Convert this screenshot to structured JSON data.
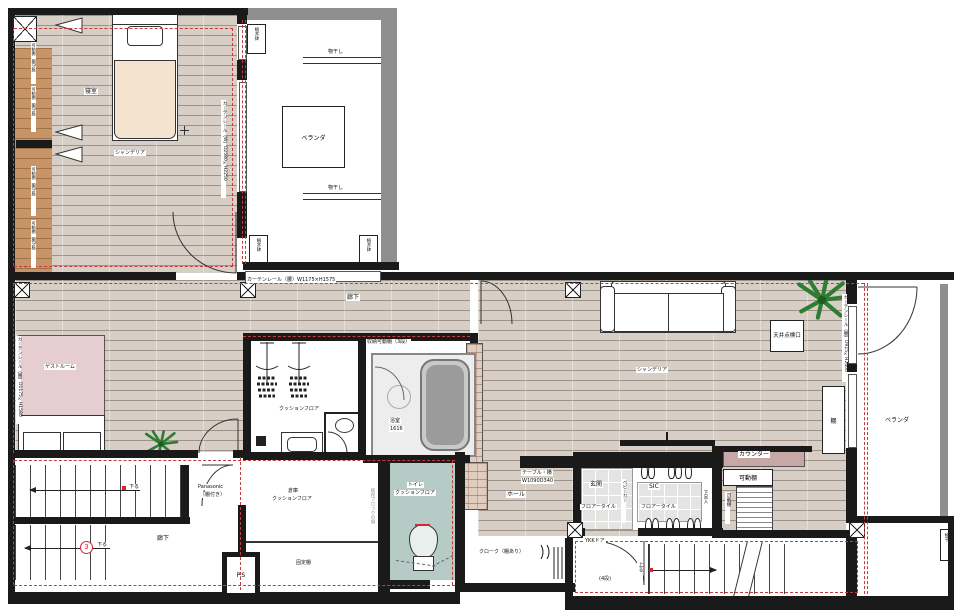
{
  "colors": {
    "wall": "#1a1a1a",
    "gray_wall": "#8f8f8f",
    "red_line": "#c43b3b",
    "wood_floor": "#d7cec6",
    "closet_wood": "#c79467",
    "guest_bed": "#e5cdd1",
    "toilet_floor": "#b6cac6",
    "counter": "#c8a7a7",
    "plant": "#2e7d32",
    "duvet": "#f4e4cf"
  },
  "labels": {
    "bedroom": "寝室",
    "bedroom_chandelier": "シャンデリア",
    "bedroom_curtain": "カーテンレール（W）D2580×H2250",
    "closet_shelf": "可動棚（棚5段）",
    "balcony_top": "ベランダ",
    "laundry_pole": "物干し",
    "planter": "植木鉢",
    "corridor_top": "廊下",
    "corridor_curtain": "カーテンレール（腰）W1175×H1575",
    "guest_room": "ゲストルーム",
    "guest_curtain": "カーテンレール（腰）D1175×H1580",
    "wic_floor": "クッションフロア",
    "wic_shelf": "収納可動棚（3段）",
    "bath": "浴室",
    "bath_size": "1616",
    "living_chandelier": "シャンデリア",
    "ceiling_hatch": "天井点検口",
    "shelf": "棚",
    "counter": "カウンター",
    "movable_shelf": "可動棚",
    "table_line1": "テーブル・横",
    "table_line2": "W1090D340",
    "living_curtain": "カーテンレール（腰）D915×H2400",
    "hall": "ホール",
    "entrance": "玄関",
    "floor_tile": "フロアータイル",
    "sic": "SIC",
    "shoe_box": "下足入",
    "stroller": "ベビーカー",
    "cloak": "クローク（棚あり）",
    "ykk_door": "YKKドア",
    "steps_4": "(4段)",
    "up": "上る",
    "down": "下る",
    "stair_num": "3",
    "corridor_bottom": "廊下",
    "storage": "倉庫",
    "storage_floor": "クッションフロア",
    "fixed_shelf": "固定棚",
    "maker": "Panasonic",
    "maker_note": "（棚付き）",
    "ps": "P.S",
    "block_note": "既存ブロックの塀",
    "toilet": "トイレ",
    "toilet_floor": "クッションフロア",
    "balcony_right": "ベランダ",
    "pole_right": "物干"
  }
}
